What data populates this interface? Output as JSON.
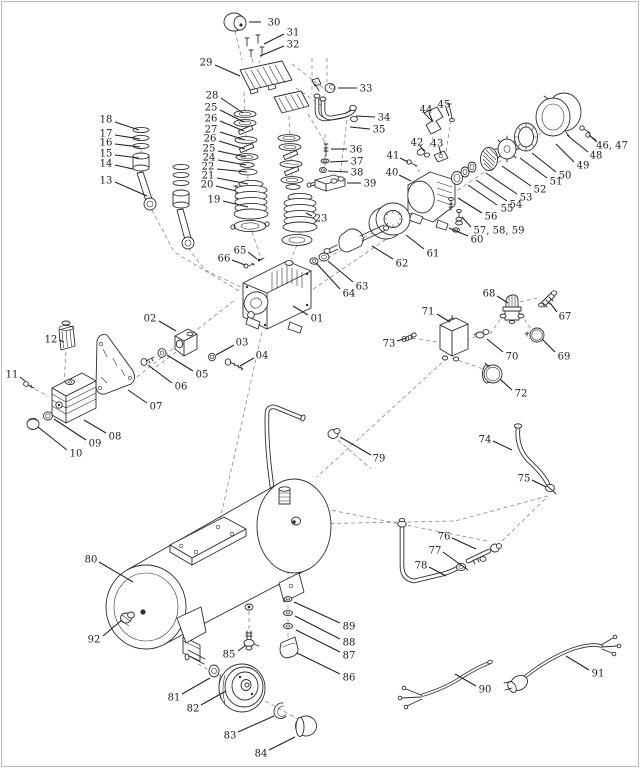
{
  "page": {
    "width": 640,
    "height": 768,
    "background_color": "#ffffff",
    "line_color": "#2e2e2e",
    "dash_color": "#8a8a8a",
    "label_color": "#1c1c1c"
  },
  "diagram": {
    "kind": "exploded-parts-diagram",
    "subject": "air compressor",
    "labels": [
      {
        "text": "30",
        "x": 274,
        "y": 22,
        "leader": [
          261,
          22,
          249,
          22
        ]
      },
      {
        "text": "31",
        "x": 293,
        "y": 32,
        "leader": [
          284,
          34,
          264,
          44
        ]
      },
      {
        "text": "32",
        "x": 293,
        "y": 44,
        "leader": [
          284,
          46,
          260,
          56
        ]
      },
      {
        "text": "29",
        "x": 206,
        "y": 62,
        "leader": [
          215,
          65,
          240,
          76
        ]
      },
      {
        "text": "28",
        "x": 212,
        "y": 95,
        "leader": [
          221,
          98,
          243,
          113
        ]
      },
      {
        "text": "25",
        "x": 211,
        "y": 107,
        "leader": [
          220,
          110,
          244,
          122
        ]
      },
      {
        "text": "26",
        "x": 211,
        "y": 118,
        "leader": [
          220,
          121,
          244,
          131
        ]
      },
      {
        "text": "27",
        "x": 211,
        "y": 129,
        "leader": [
          220,
          132,
          245,
          140
        ]
      },
      {
        "text": "26",
        "x": 210,
        "y": 138,
        "leader": [
          219,
          141,
          245,
          149
        ]
      },
      {
        "text": "25",
        "x": 209,
        "y": 148,
        "leader": [
          218,
          151,
          246,
          157
        ]
      },
      {
        "text": "24",
        "x": 209,
        "y": 157,
        "leader": [
          218,
          160,
          246,
          165
        ]
      },
      {
        "text": "22",
        "x": 208,
        "y": 166,
        "leader": [
          217,
          169,
          247,
          172
        ]
      },
      {
        "text": "21",
        "x": 208,
        "y": 175,
        "leader": [
          217,
          178,
          248,
          184
        ]
      },
      {
        "text": "20",
        "x": 207,
        "y": 184,
        "leader": [
          216,
          186,
          236,
          191
        ]
      },
      {
        "text": "19",
        "x": 214,
        "y": 199,
        "leader": [
          223,
          201,
          248,
          207
        ]
      },
      {
        "text": "18",
        "x": 106,
        "y": 119,
        "leader": [
          115,
          122,
          139,
          130
        ]
      },
      {
        "text": "17",
        "x": 106,
        "y": 133,
        "leader": [
          115,
          135,
          140,
          139
        ]
      },
      {
        "text": "16",
        "x": 106,
        "y": 142,
        "leader": [
          115,
          144,
          140,
          147
        ]
      },
      {
        "text": "15",
        "x": 106,
        "y": 153,
        "leader": [
          115,
          155,
          139,
          158
        ]
      },
      {
        "text": "14",
        "x": 106,
        "y": 163,
        "leader": [
          115,
          165,
          133,
          169
        ]
      },
      {
        "text": "13",
        "x": 106,
        "y": 180,
        "leader": [
          115,
          182,
          147,
          196
        ]
      },
      {
        "text": "23",
        "x": 321,
        "y": 218,
        "leader": [
          312,
          216,
          306,
          213
        ]
      },
      {
        "text": "33",
        "x": 366,
        "y": 88,
        "leader": [
          357,
          88,
          338,
          88
        ]
      },
      {
        "text": "34",
        "x": 384,
        "y": 117,
        "leader": [
          375,
          117,
          356,
          116
        ]
      },
      {
        "text": "35",
        "x": 379,
        "y": 129,
        "leader": [
          370,
          129,
          350,
          127
        ]
      },
      {
        "text": "36",
        "x": 356,
        "y": 149,
        "leader": [
          347,
          149,
          331,
          149
        ]
      },
      {
        "text": "37",
        "x": 357,
        "y": 161,
        "leader": [
          348,
          161,
          330,
          162
        ]
      },
      {
        "text": "38",
        "x": 357,
        "y": 172,
        "leader": [
          348,
          172,
          328,
          171
        ]
      },
      {
        "text": "39",
        "x": 370,
        "y": 183,
        "leader": [
          361,
          183,
          347,
          183
        ]
      },
      {
        "text": "41",
        "x": 393,
        "y": 155,
        "leader": [
          400,
          158,
          408,
          162
        ]
      },
      {
        "text": "40",
        "x": 392,
        "y": 172,
        "leader": [
          399,
          175,
          411,
          181
        ]
      },
      {
        "text": "42",
        "x": 417,
        "y": 142,
        "leader": [
          420,
          146,
          424,
          151
        ]
      },
      {
        "text": "43",
        "x": 437,
        "y": 143,
        "leader": [
          439,
          147,
          441,
          154
        ]
      },
      {
        "text": "44",
        "x": 426,
        "y": 109,
        "leader": [
          429,
          113,
          433,
          122
        ]
      },
      {
        "text": "45",
        "x": 444,
        "y": 104,
        "leader": [
          446,
          108,
          449,
          116
        ]
      },
      {
        "text": "46, 47",
        "x": 612,
        "y": 145,
        "leader": [
          597,
          142,
          589,
          135
        ]
      },
      {
        "text": "48",
        "x": 596,
        "y": 155,
        "leader": [
          588,
          152,
          567,
          135
        ]
      },
      {
        "text": "49",
        "x": 583,
        "y": 165,
        "leader": [
          574,
          162,
          556,
          144
        ]
      },
      {
        "text": "50",
        "x": 565,
        "y": 175,
        "leader": [
          556,
          172,
          532,
          153
        ]
      },
      {
        "text": "51",
        "x": 556,
        "y": 181,
        "leader": [
          547,
          178,
          520,
          158
        ]
      },
      {
        "text": "52",
        "x": 540,
        "y": 189,
        "leader": [
          531,
          186,
          502,
          166
        ]
      },
      {
        "text": "53",
        "x": 526,
        "y": 197,
        "leader": [
          517,
          194,
          486,
          173
        ]
      },
      {
        "text": "54",
        "x": 516,
        "y": 204,
        "leader": [
          507,
          201,
          476,
          180
        ]
      },
      {
        "text": "55",
        "x": 507,
        "y": 208,
        "leader": [
          497,
          205,
          468,
          185
        ]
      },
      {
        "text": "56",
        "x": 491,
        "y": 216,
        "leader": [
          482,
          213,
          458,
          198
        ]
      },
      {
        "text": "57, 58, 59",
        "x": 499,
        "y": 230,
        "leader": [
          471,
          227,
          462,
          217
        ]
      },
      {
        "text": "60",
        "x": 477,
        "y": 239,
        "leader": [
          468,
          236,
          449,
          228
        ]
      },
      {
        "text": "61",
        "x": 433,
        "y": 253,
        "leader": [
          424,
          249,
          406,
          235
        ]
      },
      {
        "text": "62",
        "x": 402,
        "y": 263,
        "leader": [
          393,
          259,
          372,
          246
        ]
      },
      {
        "text": "63",
        "x": 362,
        "y": 286,
        "leader": [
          353,
          282,
          328,
          261
        ]
      },
      {
        "text": "64",
        "x": 349,
        "y": 293,
        "leader": [
          340,
          289,
          317,
          264
        ]
      },
      {
        "text": "01",
        "x": 317,
        "y": 318,
        "leader": [
          308,
          315,
          293,
          306
        ]
      },
      {
        "text": "65",
        "x": 240,
        "y": 250,
        "leader": [
          248,
          252,
          257,
          259
        ]
      },
      {
        "text": "66",
        "x": 224,
        "y": 258,
        "leader": [
          232,
          260,
          245,
          265
        ]
      },
      {
        "text": "02",
        "x": 150,
        "y": 318,
        "leader": [
          159,
          321,
          176,
          331
        ]
      },
      {
        "text": "03",
        "x": 242,
        "y": 342,
        "leader": [
          234,
          345,
          216,
          355
        ]
      },
      {
        "text": "04",
        "x": 262,
        "y": 355,
        "leader": [
          254,
          358,
          240,
          366
        ]
      },
      {
        "text": "05",
        "x": 202,
        "y": 374,
        "leader": [
          193,
          371,
          167,
          355
        ]
      },
      {
        "text": "06",
        "x": 181,
        "y": 386,
        "leader": [
          172,
          383,
          148,
          365
        ]
      },
      {
        "text": "07",
        "x": 156,
        "y": 406,
        "leader": [
          147,
          403,
          128,
          390
        ]
      },
      {
        "text": "08",
        "x": 115,
        "y": 436,
        "leader": [
          106,
          433,
          84,
          420
        ]
      },
      {
        "text": "09",
        "x": 95,
        "y": 443,
        "leader": [
          86,
          440,
          54,
          419
        ]
      },
      {
        "text": "10",
        "x": 76,
        "y": 453,
        "leader": [
          67,
          450,
          38,
          427
        ]
      },
      {
        "text": "11",
        "x": 12,
        "y": 374,
        "leader": [
          20,
          377,
          25,
          381
        ]
      },
      {
        "text": "12",
        "x": 51,
        "y": 339,
        "leader": [
          59,
          340,
          64,
          342
        ]
      },
      {
        "text": "67",
        "x": 565,
        "y": 316,
        "leader": [
          557,
          312,
          550,
          303
        ]
      },
      {
        "text": "68",
        "x": 489,
        "y": 293,
        "leader": [
          497,
          296,
          508,
          303
        ]
      },
      {
        "text": "69",
        "x": 564,
        "y": 356,
        "leader": [
          555,
          352,
          542,
          339
        ]
      },
      {
        "text": "70",
        "x": 512,
        "y": 356,
        "leader": [
          503,
          352,
          487,
          339
        ]
      },
      {
        "text": "71",
        "x": 428,
        "y": 311,
        "leader": [
          437,
          314,
          450,
          322
        ]
      },
      {
        "text": "72",
        "x": 521,
        "y": 393,
        "leader": [
          512,
          390,
          500,
          379
        ]
      },
      {
        "text": "73",
        "x": 389,
        "y": 343,
        "leader": [
          397,
          341,
          407,
          338
        ]
      },
      {
        "text": "74",
        "x": 485,
        "y": 439,
        "leader": [
          493,
          441,
          512,
          450
        ]
      },
      {
        "text": "75",
        "x": 524,
        "y": 478,
        "leader": [
          532,
          480,
          546,
          487
        ]
      },
      {
        "text": "76",
        "x": 444,
        "y": 536,
        "leader": [
          452,
          538,
          476,
          549
        ]
      },
      {
        "text": "77",
        "x": 435,
        "y": 550,
        "leader": [
          443,
          552,
          468,
          570
        ]
      },
      {
        "text": "78",
        "x": 421,
        "y": 565,
        "leader": [
          429,
          567,
          446,
          576
        ]
      },
      {
        "text": "79",
        "x": 379,
        "y": 458,
        "leader": [
          371,
          455,
          340,
          437
        ]
      },
      {
        "text": "80",
        "x": 91,
        "y": 559,
        "leader": [
          99,
          562,
          133,
          582
        ]
      },
      {
        "text": "92",
        "x": 94,
        "y": 639,
        "leader": [
          103,
          636,
          122,
          620
        ]
      },
      {
        "text": "85",
        "x": 229,
        "y": 654,
        "leader": [
          238,
          651,
          246,
          645
        ]
      },
      {
        "text": "81",
        "x": 174,
        "y": 697,
        "leader": [
          182,
          694,
          210,
          678
        ]
      },
      {
        "text": "82",
        "x": 193,
        "y": 708,
        "leader": [
          201,
          705,
          226,
          691
        ]
      },
      {
        "text": "83",
        "x": 230,
        "y": 735,
        "leader": [
          238,
          732,
          274,
          716
        ]
      },
      {
        "text": "84",
        "x": 261,
        "y": 753,
        "leader": [
          269,
          750,
          295,
          737
        ]
      },
      {
        "text": "86",
        "x": 349,
        "y": 677,
        "leader": [
          340,
          674,
          297,
          653
        ]
      },
      {
        "text": "87",
        "x": 349,
        "y": 655,
        "leader": [
          340,
          652,
          296,
          630
        ]
      },
      {
        "text": "88",
        "x": 349,
        "y": 642,
        "leader": [
          340,
          639,
          295,
          616
        ]
      },
      {
        "text": "89",
        "x": 349,
        "y": 626,
        "leader": [
          340,
          623,
          294,
          602
        ]
      },
      {
        "text": "90",
        "x": 485,
        "y": 689,
        "leader": [
          476,
          686,
          455,
          674
        ]
      },
      {
        "text": "91",
        "x": 598,
        "y": 673,
        "leader": [
          589,
          670,
          566,
          656
        ]
      }
    ]
  }
}
